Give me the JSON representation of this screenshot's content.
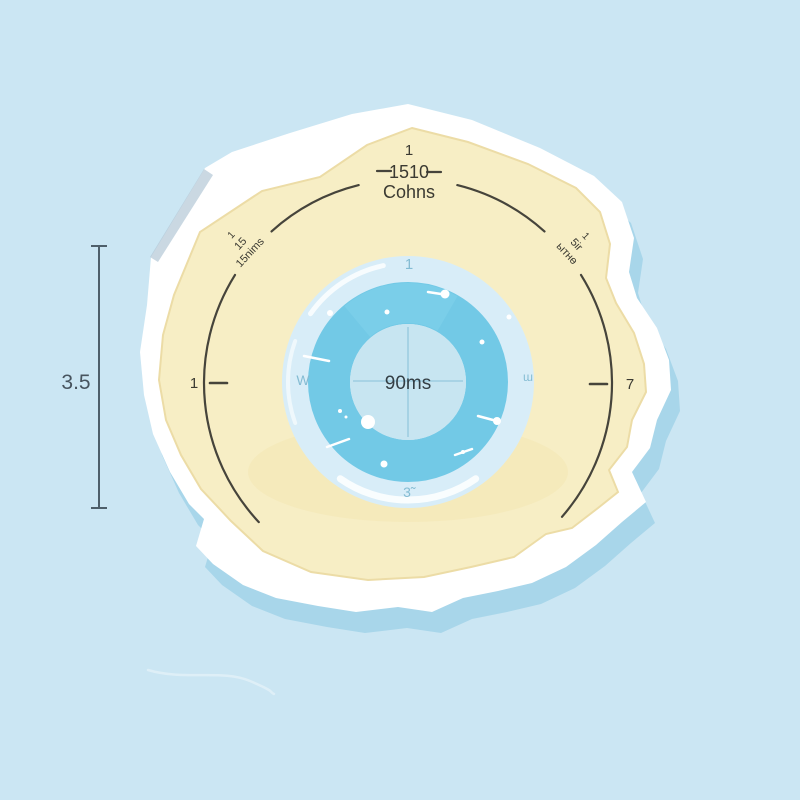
{
  "scene_title": "gauge dial on island illustration",
  "colors": {
    "background": "#cbe6f3",
    "island_sand": "#f7eec5",
    "island_rim": "#ffffff",
    "island_shadow": "#a8d6ea",
    "cliff_shade": "#b4c8d5",
    "arc_ink": "#46443b",
    "dimension_ink": "#4e5f6a",
    "ring_glass": "#d8edf8",
    "ring_band": "#72c9e6",
    "ring_inner": "#c7e5f1",
    "crosshair": "#9ecde1",
    "ring_label": "#84bcd3",
    "center_text": "#333e44",
    "sparkle": "#ffffff"
  },
  "dial": {
    "top_tick": "1",
    "top_value": "1510",
    "top_unit": "Cohns",
    "left_tick": "1",
    "right_tick": "7",
    "upper_left_lines": [
      "1",
      "15",
      "15nims"
    ],
    "upper_right_lines": [
      "1",
      "5ir",
      "ытнө"
    ]
  },
  "dimension": {
    "value": "3.5"
  },
  "ring": {
    "center_value": "90ms",
    "top_label": "1",
    "left_label": "W",
    "right_label": "ɯ",
    "bottom_label": "3̃"
  }
}
